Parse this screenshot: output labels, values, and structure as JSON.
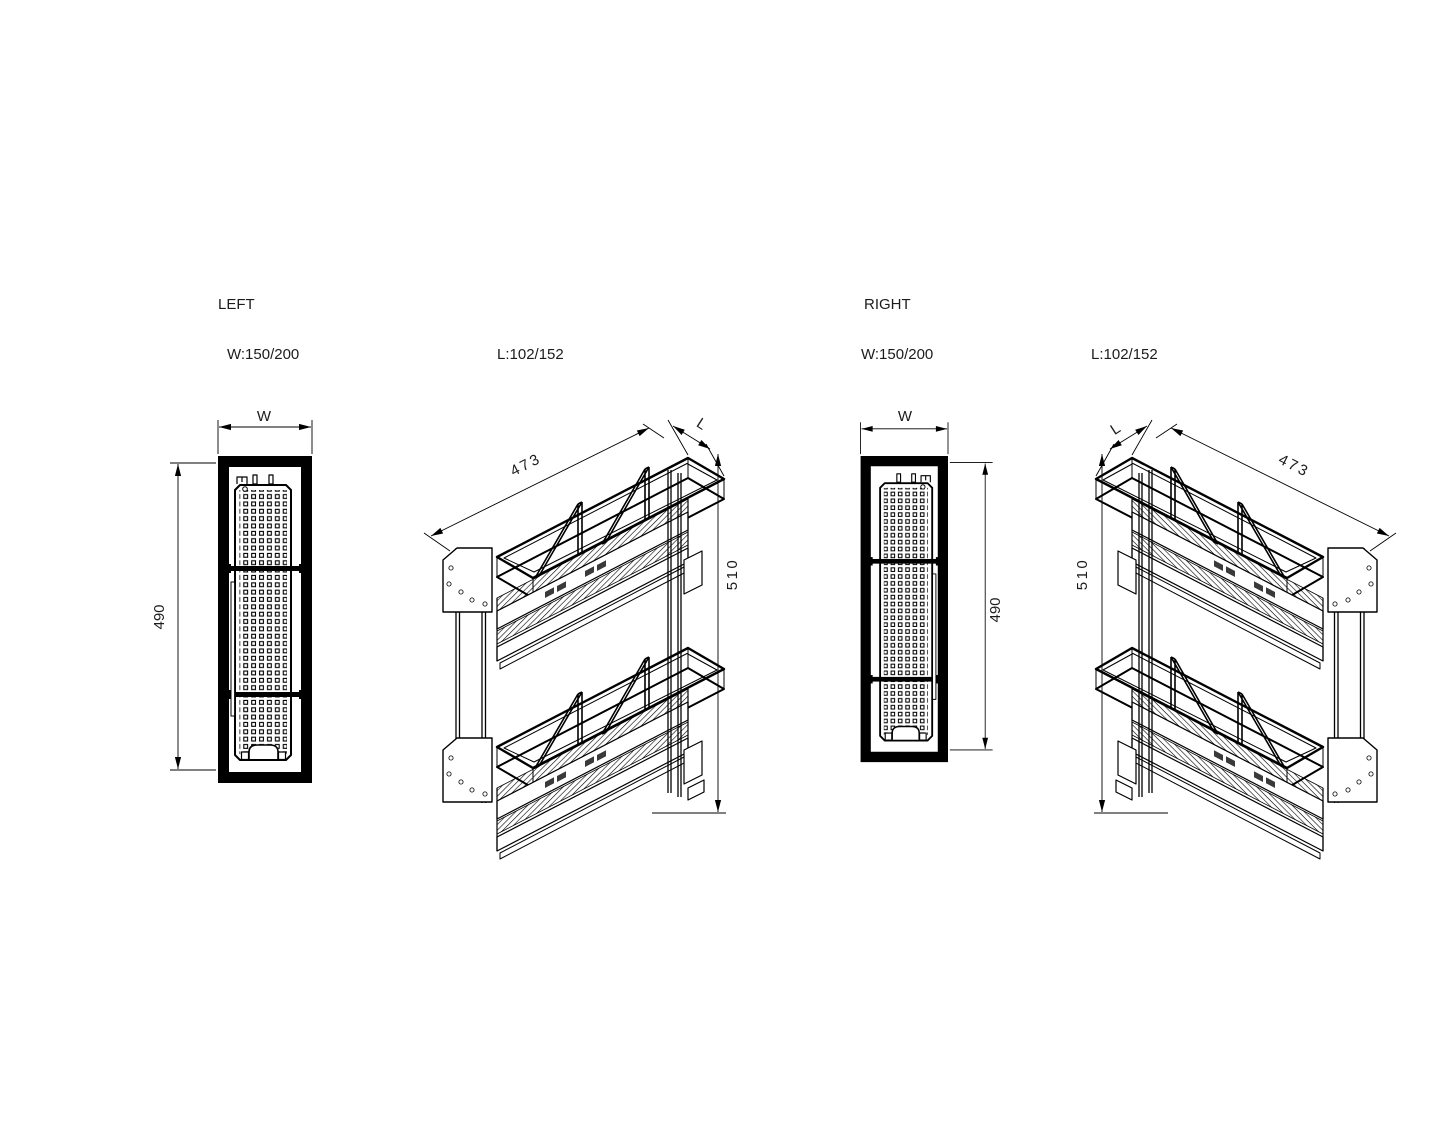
{
  "drawing": {
    "background": "#ffffff",
    "ink": "#000000",
    "sections": {
      "left": {
        "title": "LEFT",
        "width_spec": "W:150/200",
        "length_spec": "L:102/152",
        "front": {
          "width_label": "W",
          "height_label": "490"
        },
        "iso": {
          "length_label": "473",
          "depth_label": "L",
          "height_label": "510"
        }
      },
      "right": {
        "title": "RIGHT",
        "width_spec": "W:150/200",
        "length_spec": "L:102/152",
        "front": {
          "width_label": "W",
          "height_label": "490"
        },
        "iso": {
          "length_label": "473",
          "depth_label": "L",
          "height_label": "510"
        }
      }
    }
  }
}
